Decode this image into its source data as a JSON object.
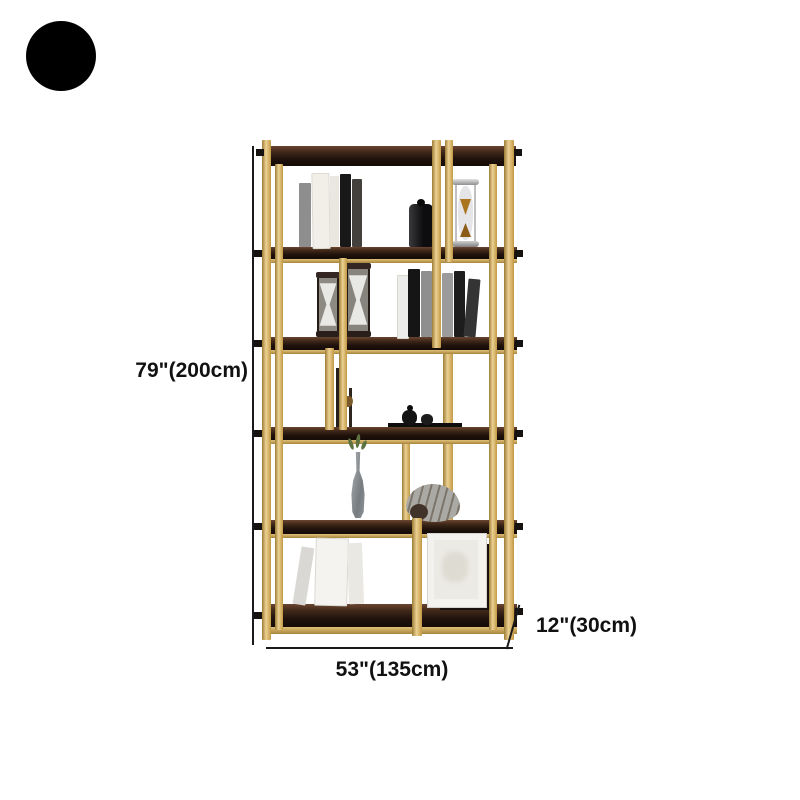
{
  "color_swatch": {
    "label": "black",
    "hex": "#000000"
  },
  "dimensions": {
    "height_label": "79\"(200cm)",
    "width_label": "53\"(135cm)",
    "depth_label": "12\"(30cm)"
  },
  "colors": {
    "frame_gold": "#c9a04e",
    "shelf_wood_dark": "#2a1912",
    "dimension_lines": "#1a1a1a",
    "background": "#ffffff"
  },
  "decor_items": [
    "standing-books",
    "black-storage-jar",
    "metal-hourglass",
    "dark-hourglass",
    "dark-hourglass",
    "standing-books",
    "twig-stems",
    "ink-pots-on-tray",
    "glass-bottle-vase",
    "nautilus-shell",
    "leaning-books",
    "picture-frame"
  ]
}
